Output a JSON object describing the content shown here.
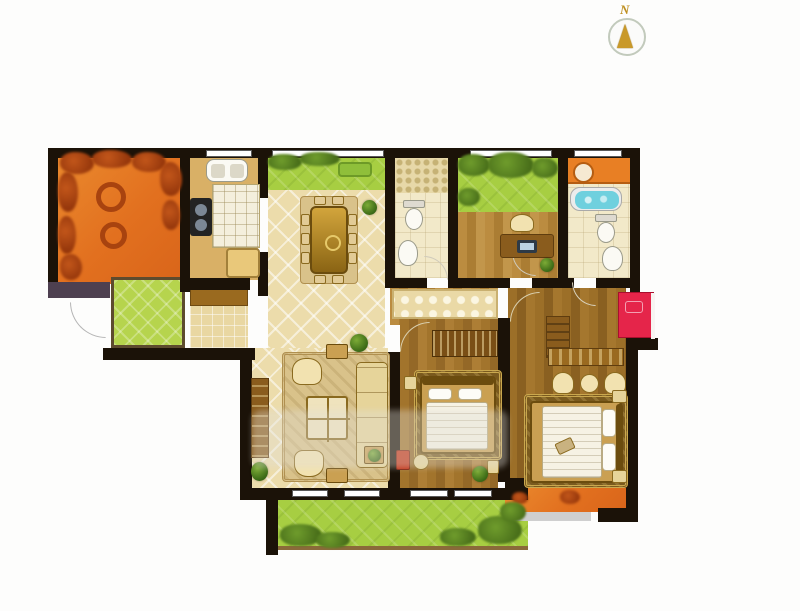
{
  "compass": {
    "label": "N"
  },
  "palette": {
    "wall": "#1b1208",
    "terrace_orange": "#e2701f",
    "balcony_grass": "#a7ce42",
    "porch_green": "#b6d44d",
    "tile_beige": "#ecdcab",
    "wood_floor": "#a2742c",
    "bath_floor": "#f2e9c9",
    "bathtub_blue": "#6fd0de",
    "wardrobe_red": "#e5254a",
    "step_gray": "#cfcfcf"
  },
  "rooms": [
    {
      "name": "terrace-northwest",
      "finish": "orange paving with foliage border",
      "furniture": [
        "round-chair",
        "round-chair"
      ]
    },
    {
      "name": "kitchen",
      "finish": "tan floor",
      "furniture": [
        "sink",
        "cooktop",
        "tiled-counter",
        "fridge"
      ]
    },
    {
      "name": "north-balcony",
      "finish": "grass",
      "furniture": [
        "garden-bench"
      ]
    },
    {
      "name": "dining-room",
      "finish": "beige diamond tile",
      "furniture": [
        "dining-table",
        "eight-chairs",
        "potted-plant"
      ]
    },
    {
      "name": "bathroom-1",
      "finish": "pale tile",
      "furniture": [
        "shower-area",
        "toilet",
        "washbasin"
      ]
    },
    {
      "name": "north-garden",
      "finish": "grass with shrubs",
      "furniture": []
    },
    {
      "name": "study",
      "finish": "wood floor",
      "furniture": [
        "desk",
        "computer",
        "chair",
        "potted-plant"
      ]
    },
    {
      "name": "master-bathroom",
      "finish": "pale tile",
      "furniture": [
        "vanity-counter",
        "bathtub",
        "toilet",
        "washbasin"
      ]
    },
    {
      "name": "entry-porch",
      "finish": "green tile",
      "furniture": [
        "entry-door-swing"
      ]
    },
    {
      "name": "entry-hall",
      "finish": "small beige tile",
      "furniture": [
        "shoe-cabinet"
      ]
    },
    {
      "name": "living-room",
      "finish": "beige diamond tile",
      "furniture": [
        "tv-cabinet",
        "sofa-set",
        "coffee-table",
        "armchairs",
        "side-tables",
        "potted-plants",
        "area-rug"
      ]
    },
    {
      "name": "hallway",
      "finish": "wood floor with decorative runner",
      "furniture": []
    },
    {
      "name": "bedroom-2",
      "finish": "wood floor",
      "furniture": [
        "wardrobe",
        "double-bed",
        "nightstands",
        "dresser",
        "stool",
        "potted-plant"
      ]
    },
    {
      "name": "master-bedroom",
      "finish": "wood floor",
      "furniture": [
        "red-wardrobe",
        "tall-dresser",
        "low-dresser",
        "three-chairs",
        "double-bed",
        "nightstands",
        "area-rug"
      ]
    },
    {
      "name": "south-balcony",
      "finish": "grass with shrubs",
      "furniture": []
    },
    {
      "name": "southeast-balcony",
      "finish": "orange paving",
      "furniture": [
        "gray-step"
      ]
    }
  ]
}
